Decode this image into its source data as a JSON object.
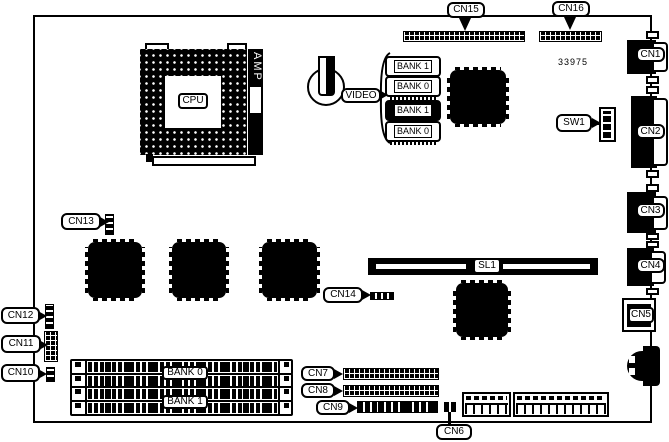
{
  "part_number": "33975",
  "cpu": {
    "label": "CPU",
    "socket_brand": "AMP"
  },
  "video": {
    "label": "VIDEO",
    "chips": [
      {
        "label": "BANK 1"
      },
      {
        "label": "BANK 0"
      },
      {
        "label": "BANK 1"
      },
      {
        "label": "BANK 0"
      }
    ]
  },
  "slot": {
    "sl1": "SL1"
  },
  "dip_switch": {
    "sw1": "SW1"
  },
  "memory": {
    "bank0": "BANK 0",
    "bank1": "BANK 1"
  },
  "connectors": {
    "cn1": "CN1",
    "cn2": "CN2",
    "cn3": "CN3",
    "cn4": "CN4",
    "cn5": "CN5",
    "cn6": "CN6",
    "cn7": "CN7",
    "cn8": "CN8",
    "cn9": "CN9",
    "cn10": "CN10",
    "cn11": "CN11",
    "cn12": "CN12",
    "cn13": "CN13",
    "cn14": "CN14",
    "cn15": "CN15",
    "cn16": "CN16"
  }
}
